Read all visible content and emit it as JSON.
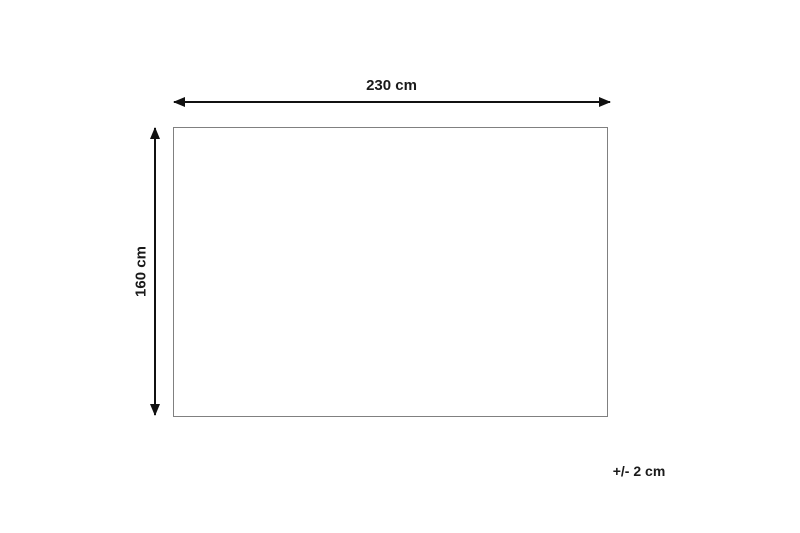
{
  "diagram": {
    "type": "product-dimension-diagram",
    "width_label": "230 cm",
    "height_label": "160 cm",
    "tolerance_label": "+/- 2 cm",
    "colors": {
      "background": "#ffffff",
      "arrow": "#111111",
      "rect_border": "#808080",
      "text": "#1a1a1a"
    }
  }
}
